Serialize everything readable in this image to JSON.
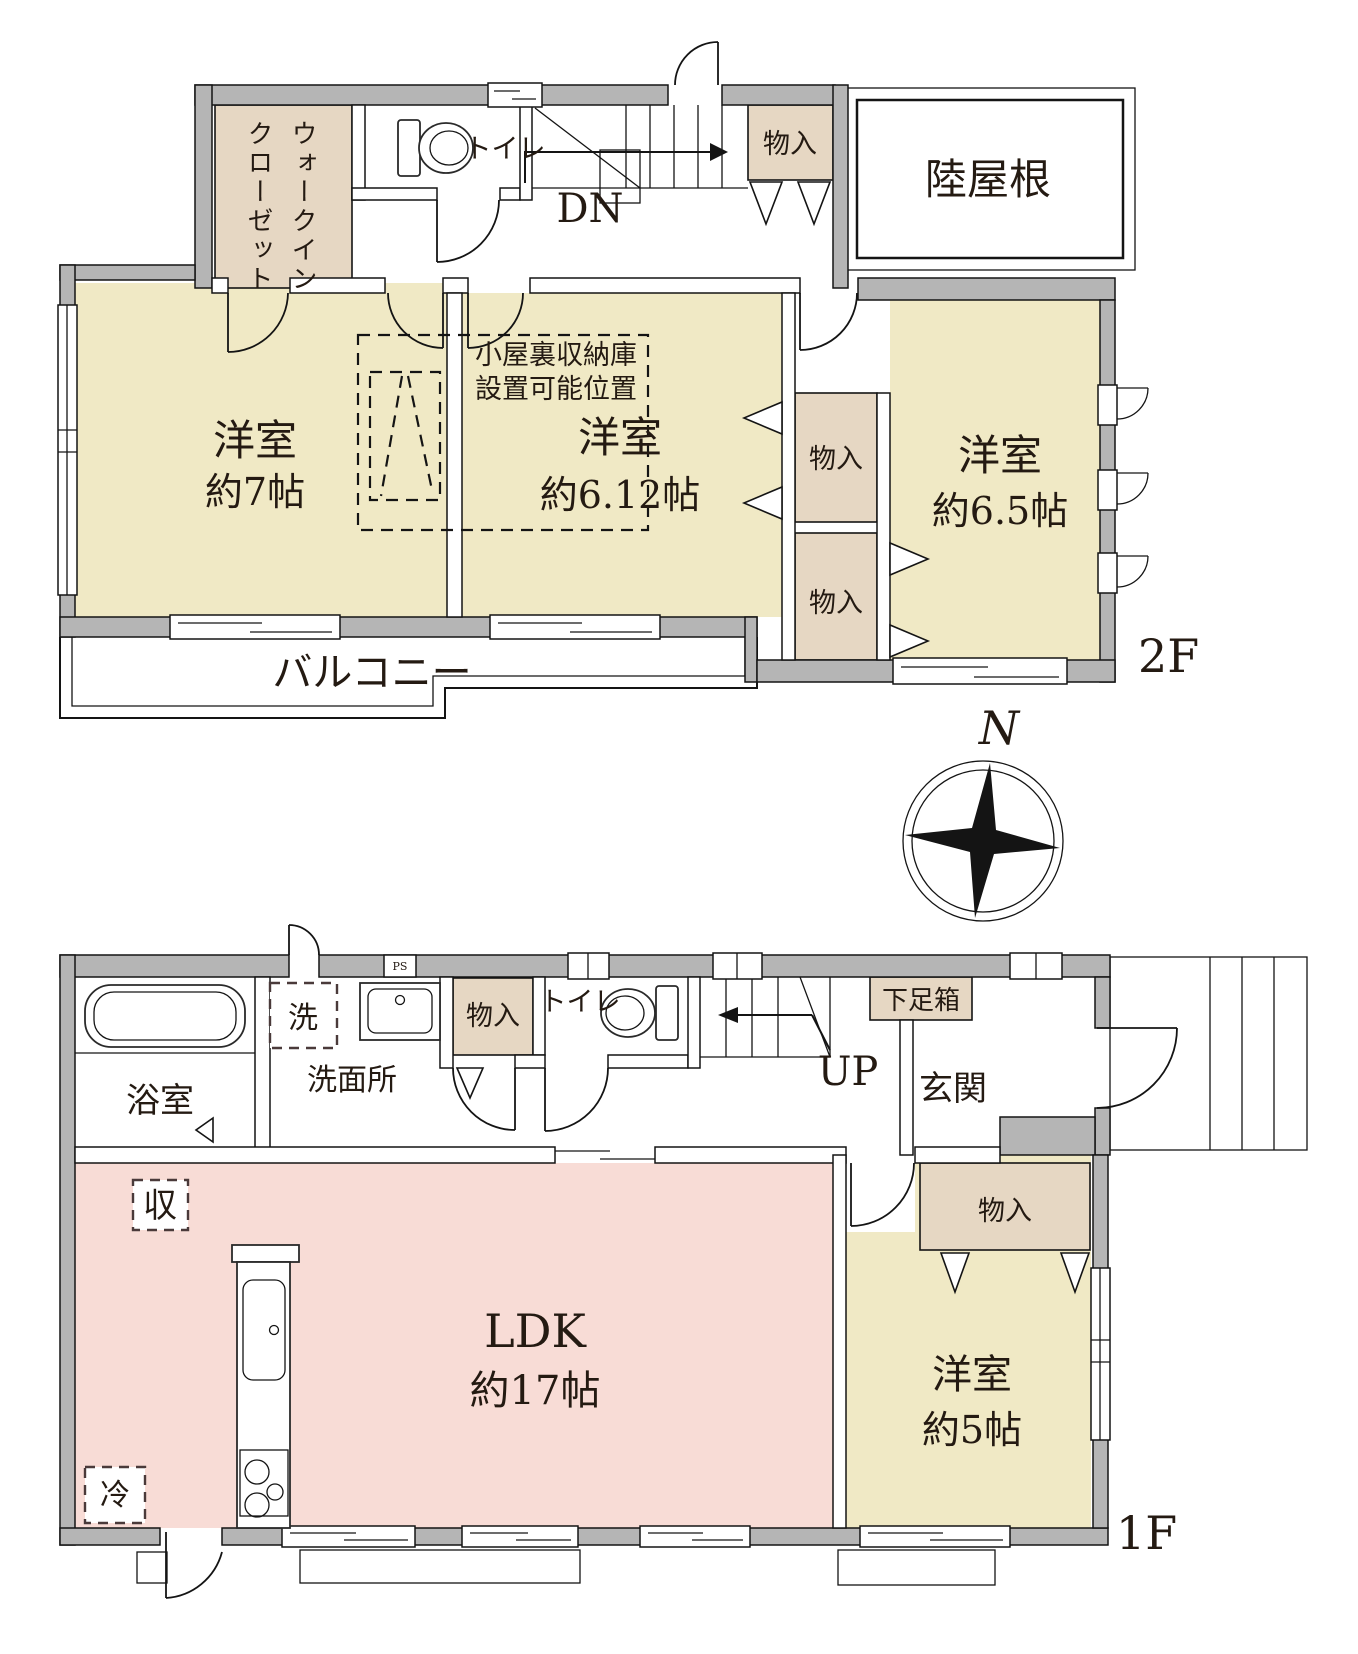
{
  "colors": {
    "wall_gray": "#b5b5b5",
    "room_yellow": "#f0e9c5",
    "room_pink": "#f8dcd6",
    "storage_beige": "#e6d7c3",
    "line": "#141414"
  },
  "floor2": {
    "tag": "2F",
    "walk_in_closet_lines": [
      "ウォークイン",
      "クローゼット"
    ],
    "toilet": "トイレ",
    "down": "DN",
    "storage_top": "物入",
    "flat_roof": "陸屋根",
    "room7_name": "洋室",
    "room7_size": "約7帖",
    "room612_name": "洋室",
    "room612_size": "約6.12帖",
    "room65_name": "洋室",
    "room65_size": "約6.5帖",
    "attic_note_lines": [
      "小屋裏収納庫",
      "設置可能位置"
    ],
    "storage_mid_upper": "物入",
    "storage_mid_lower": "物入",
    "balcony": "バルコニー"
  },
  "compass": {
    "north": "N"
  },
  "floor1": {
    "tag": "1F",
    "bathroom": "浴室",
    "washer": "洗",
    "pipe_space": "PS",
    "washroom": "洗面所",
    "storage_top": "物入",
    "toilet": "トイレ",
    "up": "UP",
    "shoe_box": "下足箱",
    "entrance": "玄関",
    "storage_note": "収",
    "fridge": "冷",
    "ldk_name": "LDK",
    "ldk_size": "約17帖",
    "storage_east": "物入",
    "room5_name": "洋室",
    "room5_size": "約5帖"
  }
}
